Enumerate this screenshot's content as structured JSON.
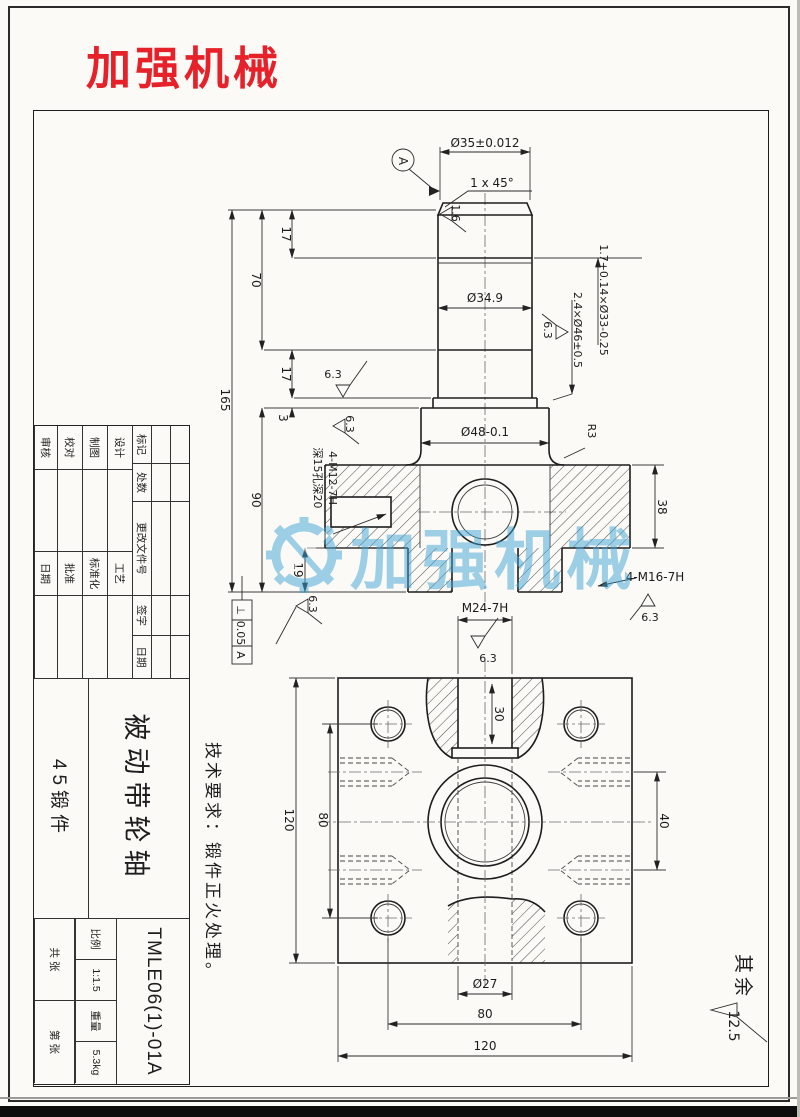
{
  "logo": {
    "text": "加强机械"
  },
  "watermark": {
    "text": "加强机械"
  },
  "note": {
    "text": "技术要求：锻件正火处理。"
  },
  "corner": {
    "label": "其余",
    "value": "12.5"
  },
  "colors": {
    "logo_red": "#e6212a",
    "watermark_blue": "#3fa4d8"
  },
  "front": {
    "datum": "A",
    "finish16": "1.6",
    "finish63": "6.3",
    "dia35": "Ø35±0.012",
    "chamfer": "1 x 45°",
    "dia349": "Ø34.9",
    "dia48": "Ø48-0.1",
    "groove_top": "1.7+0.14×Ø33-0.25",
    "groove_mid": "2.4×Ø46±0.5",
    "r3": "R3",
    "d17a": "17",
    "d70": "70",
    "d165": "165",
    "d17b": "17",
    "d3": "3",
    "d90": "90",
    "d19": "19",
    "d38": "38",
    "m12": "4-M12-7H",
    "m12depth": "深15孔深20",
    "m16": "4-M16-7H",
    "tol": {
      "symbol": "⊥",
      "value": "0.05",
      "datum": "A"
    }
  },
  "bottom": {
    "m24": "M24-7H",
    "finish63": "6.3",
    "d30": "30",
    "d120_left": "120",
    "d80_left": "80",
    "d40": "40",
    "dia27": "Ø27",
    "d80_bottom": "80",
    "d120_bottom": "120"
  },
  "titleblock": {
    "rev_headers": [
      "标记",
      "处数",
      "更改文件号",
      "签字",
      "日期"
    ],
    "roles": [
      {
        "left": "设计",
        "right": "工艺"
      },
      {
        "left": "制图",
        "right": "标准化"
      },
      {
        "left": "校对",
        "right": "批准"
      },
      {
        "left": "审核",
        "right": "日期"
      }
    ],
    "part_name": "被动带轮轴",
    "material": "45锻件",
    "drawing_no": "TMLE06(1)-01A",
    "scale_label": "比例",
    "scale_value": "1:1.5",
    "weight_label": "重量",
    "weight_value": "5.3kg",
    "sheet_total": "共  张",
    "sheet_no": "第  张"
  }
}
